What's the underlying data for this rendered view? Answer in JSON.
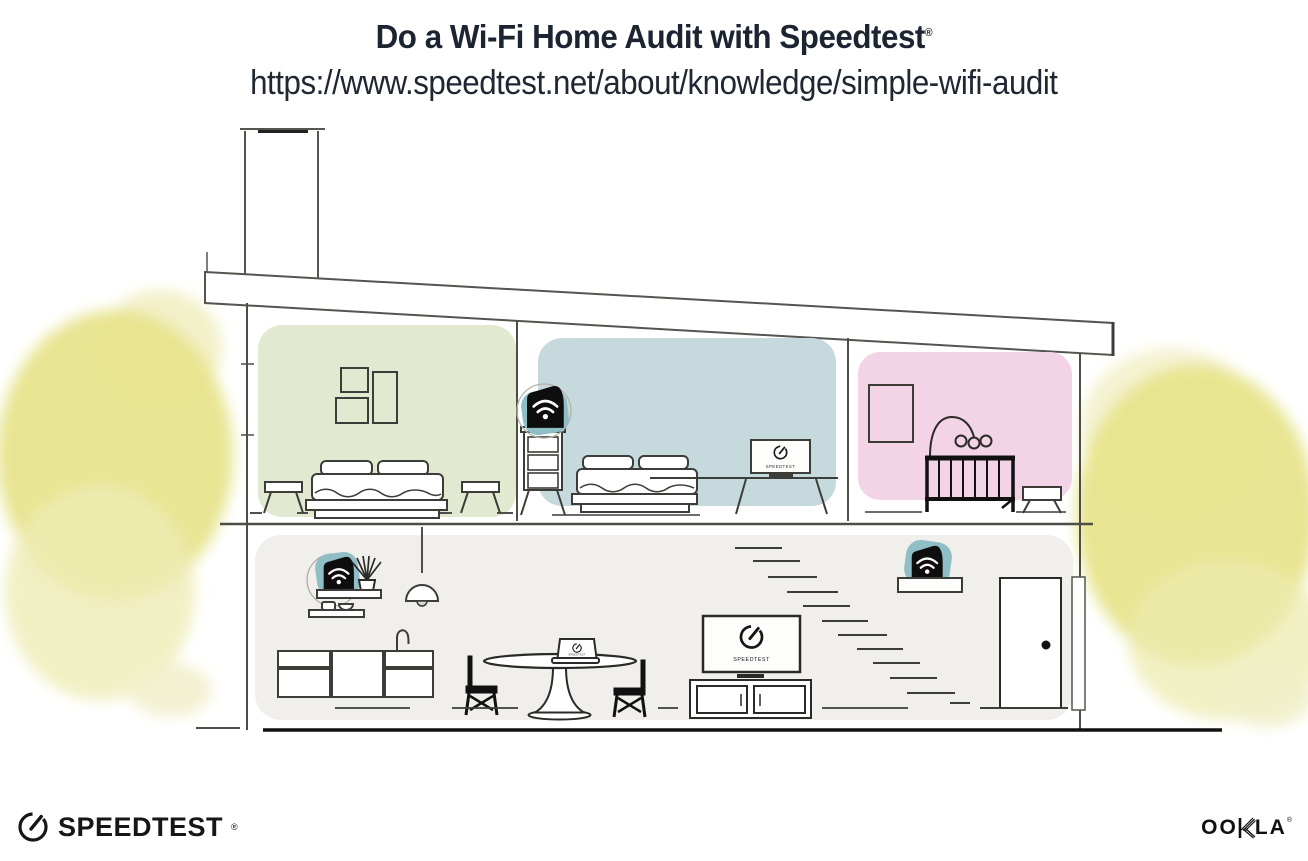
{
  "header": {
    "title": "Do a Wi-Fi Home Audit with Speedtest",
    "registered": "®",
    "url": "https://www.speedtest.net/about/knowledge/simple-wifi-audit"
  },
  "screens": {
    "bedroom_tv_label": "SPEEDTEST",
    "living_tv_label": "SPEEDTEST",
    "laptop_label": "SPEEDTEST"
  },
  "footer": {
    "speedtest_wordmark": "SPEEDTEST",
    "speedtest_registered": "®",
    "ookla_wordmark_left": "OO",
    "ookla_wordmark_right": "LA",
    "ookla_registered": "®"
  },
  "icons": {
    "gauge": "speedtest-gauge-icon",
    "wifi": "wifi-signal-icon",
    "router": "wifi-router-device",
    "extender": "wifi-extender-device"
  },
  "colors": {
    "room_green": "#e1e9d0",
    "room_teal": "#c6d9dc",
    "room_pink": "#f3d3e6",
    "ground_floor": "#f0efeb",
    "device_teal": "#8fbec6",
    "tree_yellow": "#e7e48c",
    "line_gray": "#4e4e49",
    "ink": "#111111",
    "title_navy": "#1b2430"
  }
}
